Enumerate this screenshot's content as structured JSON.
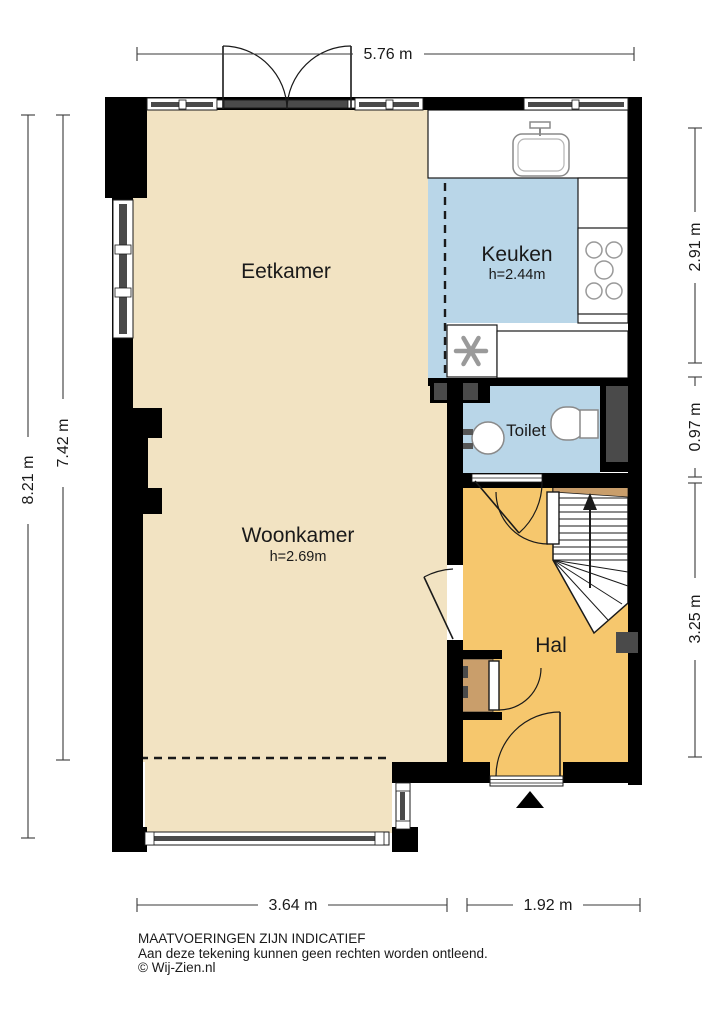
{
  "plan": {
    "rooms": {
      "eetkamer": {
        "label": "Eetkamer"
      },
      "keuken": {
        "label": "Keuken",
        "height": "h=2.44m"
      },
      "woonkamer": {
        "label": "Woonkamer",
        "height": "h=2.69m"
      },
      "toilet": {
        "label": "Toilet"
      },
      "hal": {
        "label": "Hal"
      }
    },
    "colors": {
      "floor_living_dining": "#f2e3c2",
      "floor_kitchen_toilet": "#b9d6e8",
      "floor_hall": "#f6c76d",
      "floor_closet": "#c99e6b",
      "wall": "#000000",
      "shaft": "#4a4a4a"
    }
  },
  "dimensions": {
    "top": "5.76 m",
    "left_outer": "8.21 m",
    "left_inner": "7.42 m",
    "right_top": "2.91 m",
    "right_middle": "0.97 m",
    "right_bottom": "3.25 m",
    "bottom_left": "3.64 m",
    "bottom_right": "1.92 m"
  },
  "footer": {
    "line1": "MAATVOERINGEN ZIJN INDICATIEF",
    "line2": "Aan deze tekening kunnen geen rechten worden ontleend.",
    "line3": "© Wij-Zien.nl"
  }
}
